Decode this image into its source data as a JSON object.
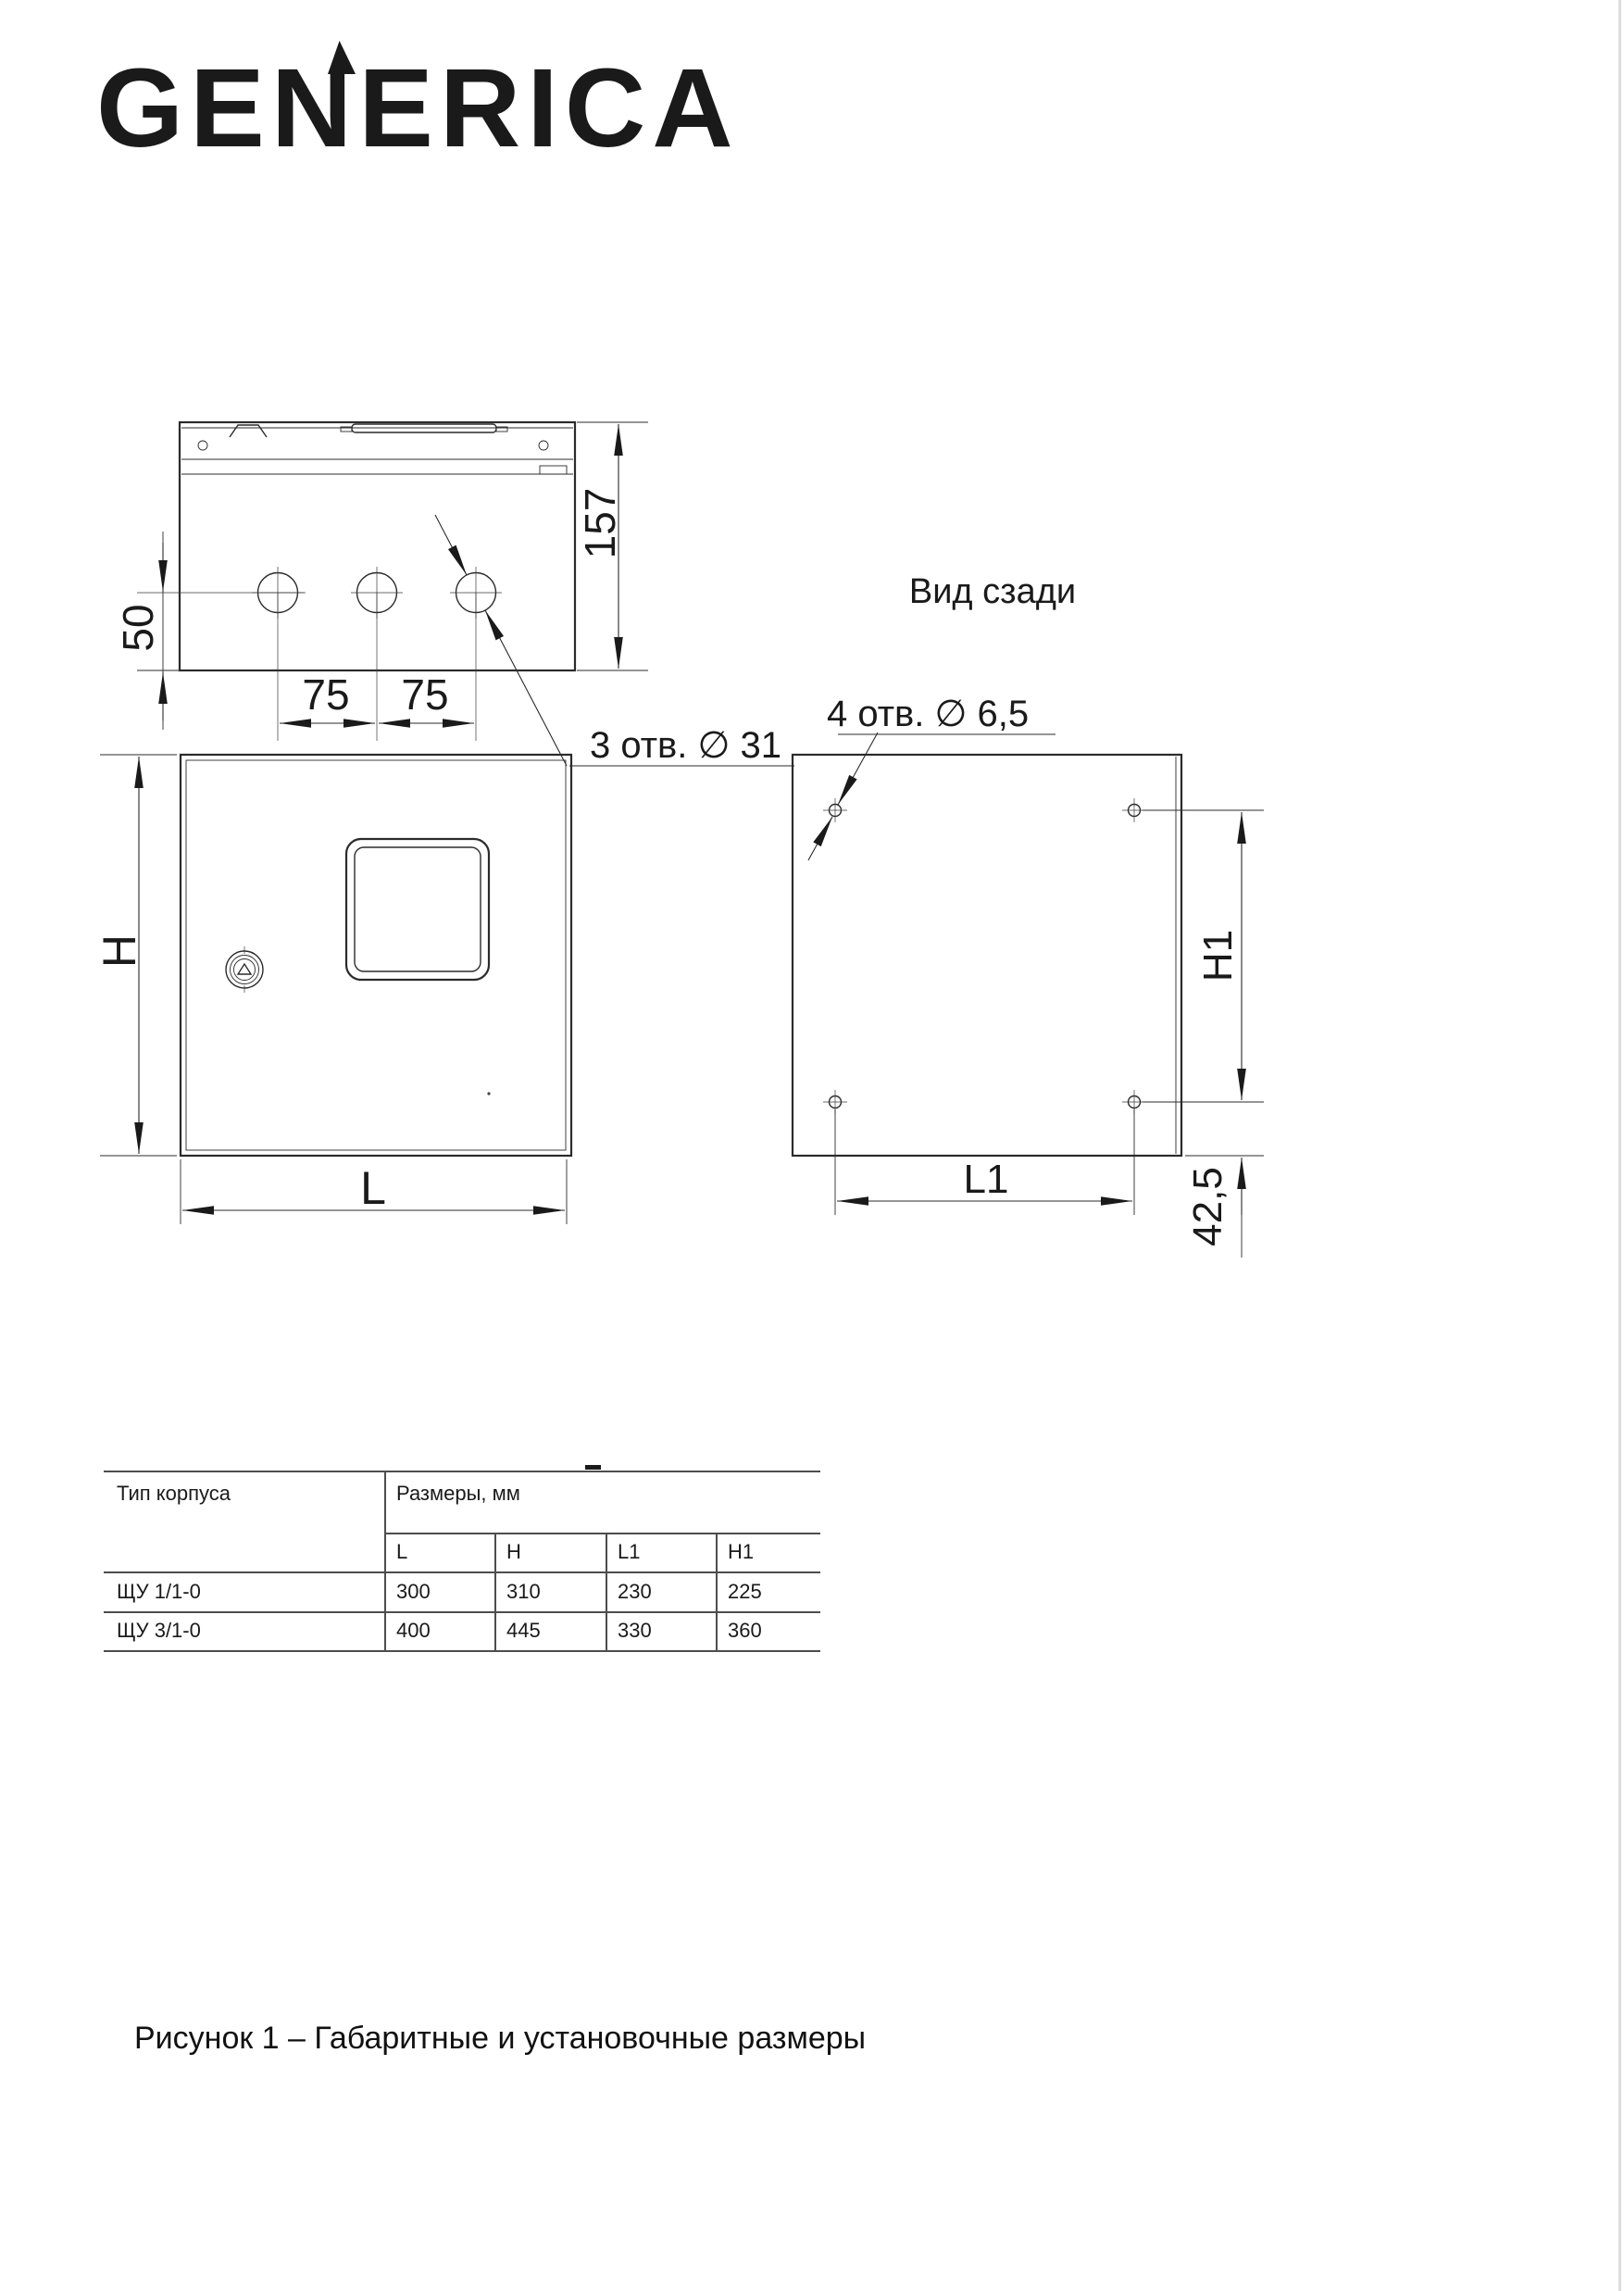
{
  "brand": {
    "logo_text": "GENERICA"
  },
  "views": {
    "top": {
      "dim_depth": "157",
      "dim_hole_offset": "50",
      "dim_spacing_left": "75",
      "dim_spacing_right": "75",
      "holes_note": "3 отв. ∅ 31"
    },
    "front": {
      "dim_height": "H",
      "dim_width": "L"
    },
    "rear": {
      "title": "Вид сзади",
      "holes_note": "4 отв. ∅ 6,5",
      "dim_height": "H1",
      "dim_width": "L1",
      "dim_bottom_offset": "42,5"
    }
  },
  "table": {
    "header_type": "Тип корпуса",
    "header_dims": "Размеры, мм",
    "sub_headers": [
      "L",
      "H",
      "L1",
      "H1"
    ],
    "rows": [
      {
        "type": "ЩУ 1/1-0",
        "values": [
          "300",
          "310",
          "230",
          "225"
        ]
      },
      {
        "type": "ЩУ 3/1-0",
        "values": [
          "400",
          "445",
          "330",
          "360"
        ]
      }
    ]
  },
  "caption": "Рисунок 1 – Габаритные и установочные размеры",
  "colors": {
    "line": "#2b2b2b",
    "text": "#1a1a1a",
    "table_line": "#4d4d4d",
    "page_edge": "#dddddd"
  }
}
